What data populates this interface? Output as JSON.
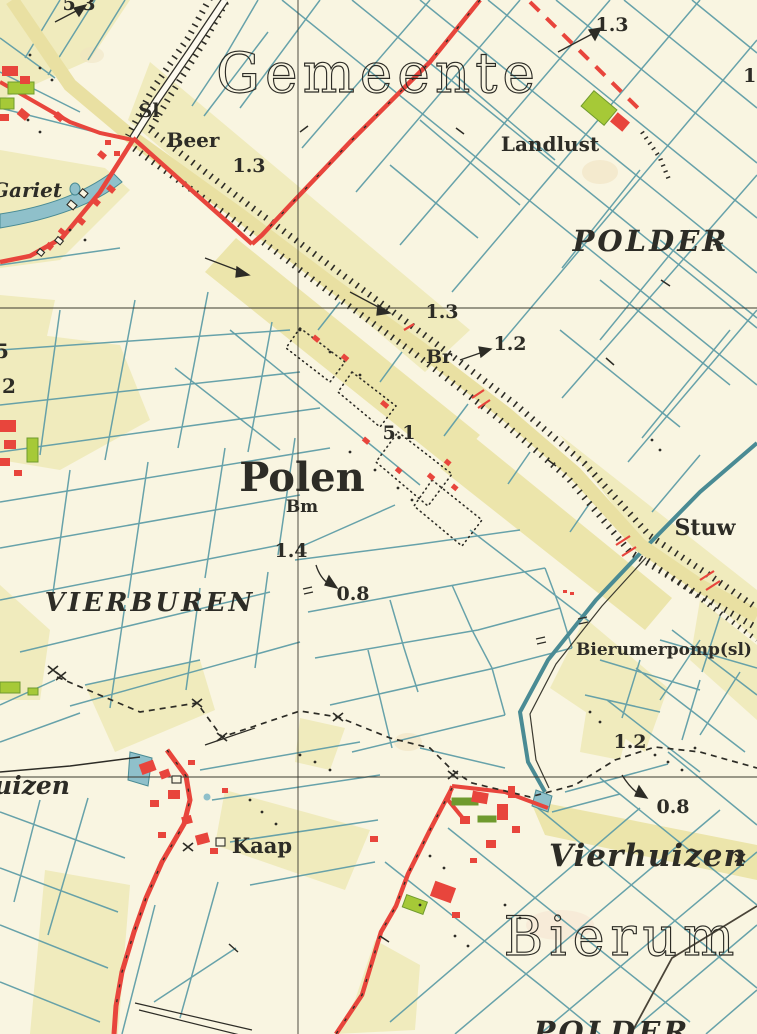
{
  "map": {
    "region_names": {
      "gemeente": "Gemeente",
      "bierum": "Bierum"
    },
    "area_labels": {
      "polder_ne": "POLDER",
      "polder_s": "POLDER",
      "vierburen": "VIERBUREN"
    },
    "settlements": {
      "polen": "Polen",
      "polen_marker": "Bm",
      "vierhuizen": "Vierhuizen",
      "uizen_partial": "uizen",
      "beer": "Beer",
      "landlust": "Landlust",
      "kaap": "Kaap",
      "gariet": "Gariet"
    },
    "features": {
      "sl": "Sl",
      "br": "Br",
      "stuw": "Stuw",
      "bierumerpomp": "Bierumerpomp(sl)"
    },
    "spot_heights": {
      "top_left": "5.3",
      "beer": "1.3",
      "landlust_road": "1.3",
      "dike": "1.3",
      "br": "1.2",
      "polen": "5.1",
      "polen_south": "1.4",
      "vierburen": "0.8",
      "vierhuizen_north": "1.2",
      "vierhuizen": "0.8",
      "edge_left_a": "5",
      "edge_left_b": "2",
      "edge_right": "1."
    },
    "colors": {
      "background": "#f9f5e1",
      "field_yellow": "#f0ebbd",
      "ditch_teal": "#5f9da6",
      "water": "#8fc0ca",
      "road_red": "#e8453c",
      "ink": "#2d2c26",
      "green": "#a6c937",
      "dike_tan": "#e9e0a2"
    }
  }
}
